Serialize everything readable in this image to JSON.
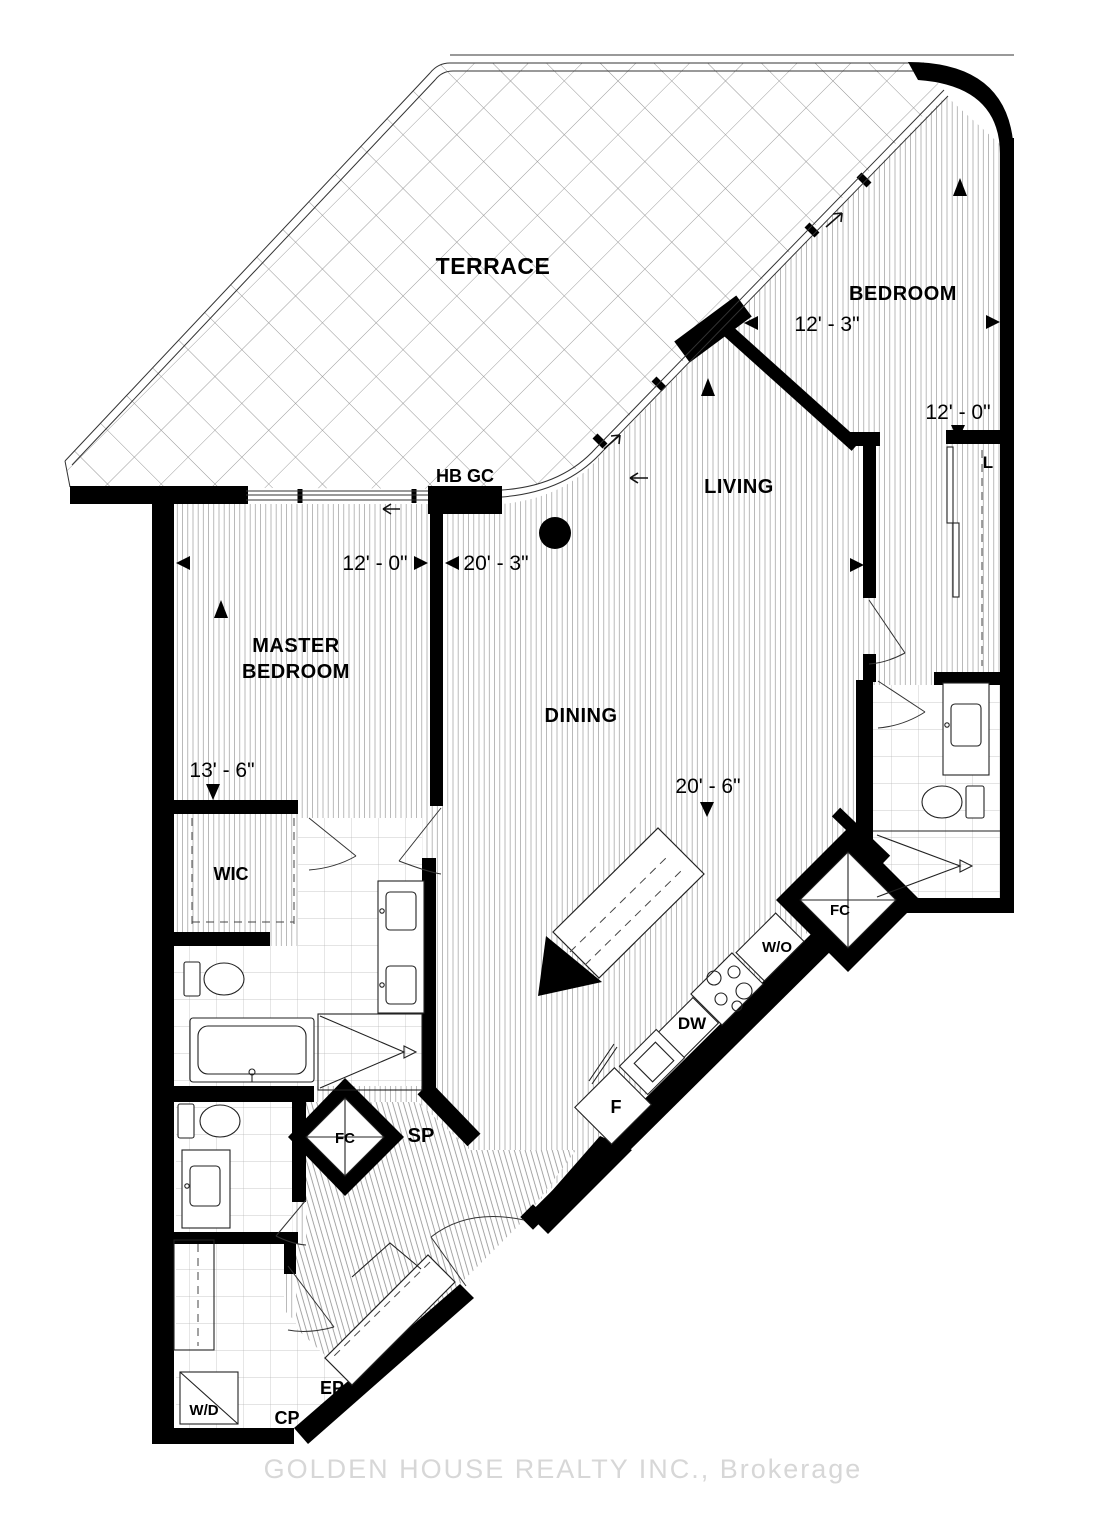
{
  "floorplan": {
    "rooms": {
      "terrace": "TERRACE",
      "bedroom": "BEDROOM",
      "living": "LIVING",
      "dining": "DINING",
      "master_line1": "MASTER",
      "master_line2": "BEDROOM",
      "wic": "WIC"
    },
    "dimensions": {
      "master_width": "12' - 0\"",
      "living_width": "20' - 3\"",
      "master_depth": "13' - 6\"",
      "dining_width": "20' - 6\"",
      "bedroom_width": "12' - 3\"",
      "bedroom_depth": "12' - 0\""
    },
    "labels": {
      "hose_bib_gas_cock": "HB GC",
      "linen_closet": "L",
      "fan_coil_kitchen": "FC",
      "fan_coil_hall": "FC",
      "sprinkler": "SP",
      "wall_oven": "W/O",
      "dishwasher": "DW",
      "fridge": "F",
      "washer_dryer": "W/D",
      "closet_cp": "CP",
      "panel_ep": "EP"
    },
    "watermark": "GOLDEN HOUSE REALTY INC., Brokerage"
  }
}
